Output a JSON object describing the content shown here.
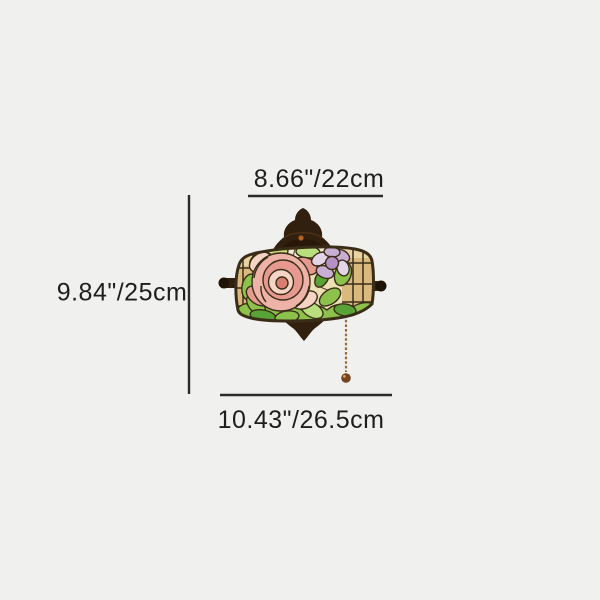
{
  "page": {
    "background": "#f0f0ee"
  },
  "diagram": {
    "top_dimension": {
      "label": "8.66\"/22cm"
    },
    "left_dimension": {
      "label": "9.84\"/25cm"
    },
    "bottom_dimension": {
      "label": "10.43\"/26.5cm"
    }
  },
  "illustration": {
    "alt": "tiffany-stained-glass-rose-wall-sconce"
  },
  "colors": {
    "background": "#f0f0ee",
    "text": "#1e1e1e",
    "dimension_line": "#2b2b2b",
    "bronze_hardware": "#32200e",
    "lead_came": "#3a2d18",
    "glass_cream": "#ebdfb4",
    "glass_tan": "#d9b97e",
    "leaf_green": "#8cc24b",
    "rose_pink": "#eeb3a8",
    "flower_purple": "#c9aed4",
    "chain_brass": "#9b6c3a"
  }
}
